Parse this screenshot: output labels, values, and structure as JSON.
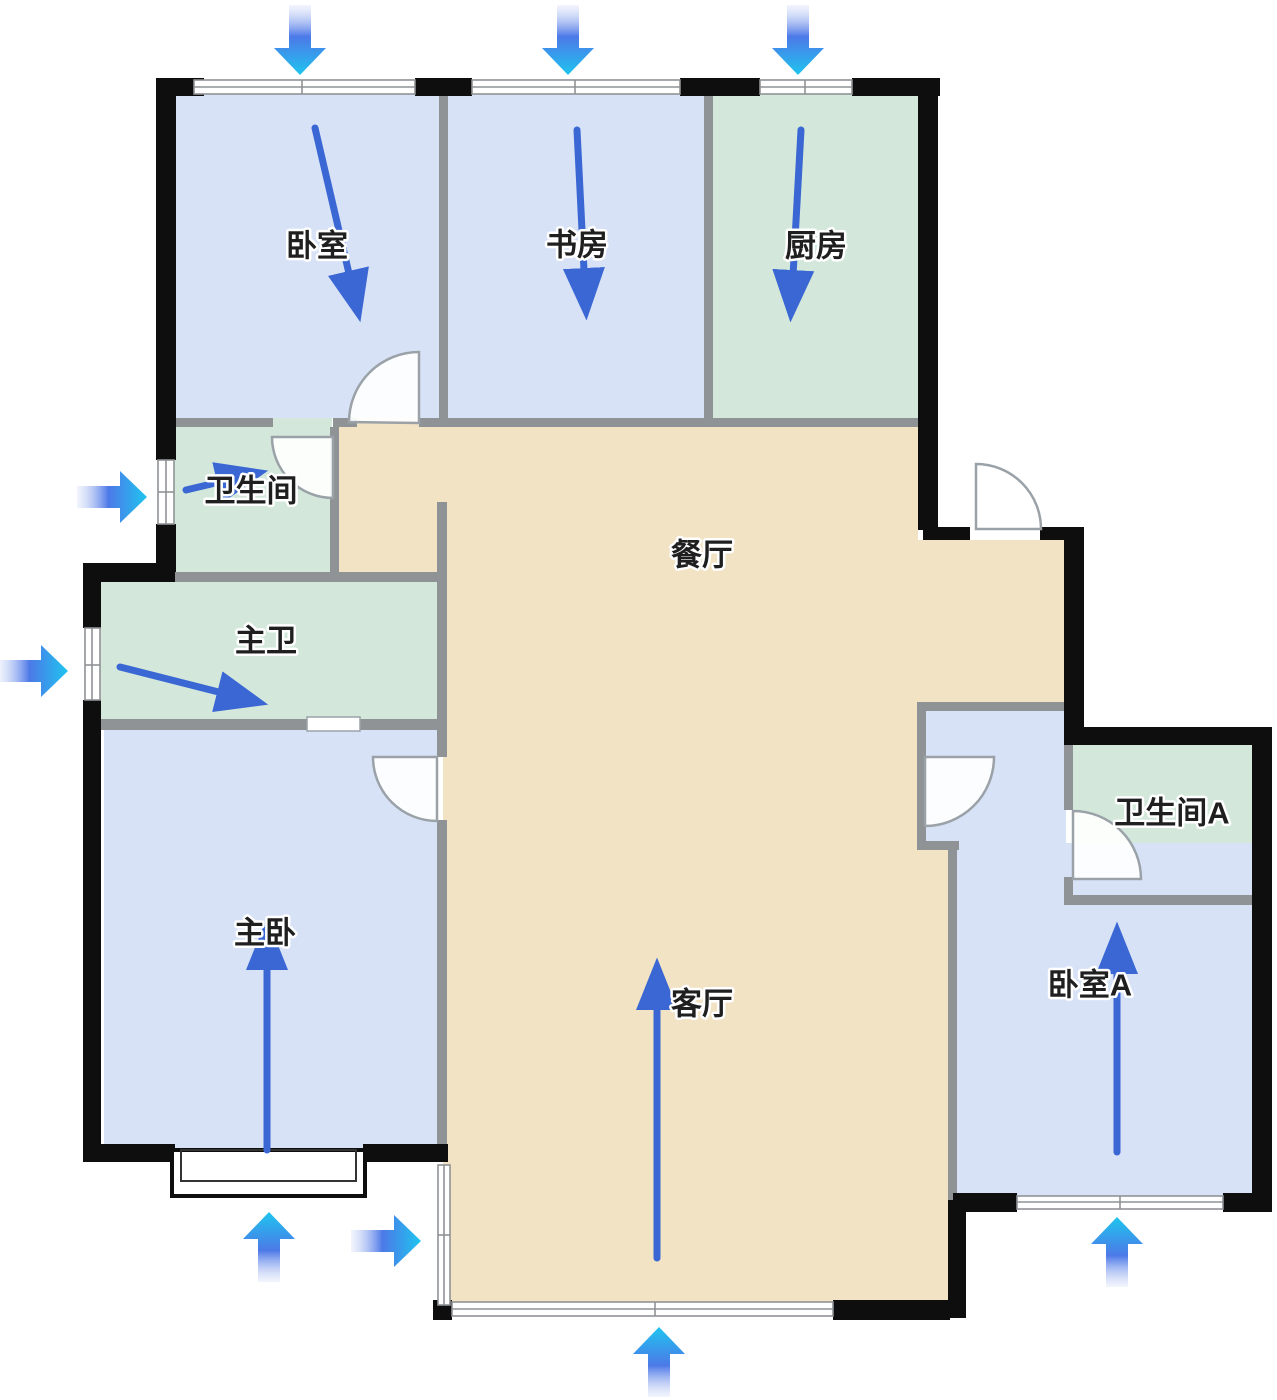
{
  "rooms": {
    "bedroom": {
      "label": "卧室"
    },
    "study": {
      "label": "书房"
    },
    "kitchen": {
      "label": "厨房"
    },
    "bathroom": {
      "label": "卫生间"
    },
    "master_bath": {
      "label": "主卫"
    },
    "dining": {
      "label": "餐厅"
    },
    "master_bedroom": {
      "label": "主卧"
    },
    "living": {
      "label": "客厅"
    },
    "bathroom_a": {
      "label": "卫生间A"
    },
    "bedroom_a": {
      "label": "卧室A"
    }
  },
  "colors": {
    "room_blue": "#d8e2f7",
    "room_green": "#d3e8db",
    "room_tan": "#f2e3c5",
    "wall_black": "#0e0e0e",
    "wall_gray": "#8f9396",
    "door_gray": "#9aa2a8",
    "flow_blue": "#3a67d4",
    "ext_tail": "#ccd5f7",
    "ext_mid": "#4c79e7",
    "ext_tip": "#1fc5ef",
    "label_black": "#1f1f1f",
    "background": "#ffffff"
  },
  "arrows": {
    "exterior": [
      {
        "id": "top-1",
        "direction": "down"
      },
      {
        "id": "top-2",
        "direction": "down"
      },
      {
        "id": "top-3",
        "direction": "down"
      },
      {
        "id": "left-1",
        "direction": "right"
      },
      {
        "id": "left-2",
        "direction": "right"
      },
      {
        "id": "bottom-1",
        "direction": "up"
      },
      {
        "id": "bottom-2",
        "direction": "right"
      },
      {
        "id": "bottom-3",
        "direction": "up"
      },
      {
        "id": "bottom-4",
        "direction": "up"
      }
    ],
    "interior": [
      {
        "room": "卧室",
        "direction": "down-right"
      },
      {
        "room": "书房",
        "direction": "down"
      },
      {
        "room": "厨房",
        "direction": "down"
      },
      {
        "room": "卫生间",
        "direction": "right"
      },
      {
        "room": "主卫",
        "direction": "down-right"
      },
      {
        "room": "主卧",
        "direction": "up"
      },
      {
        "room": "客厅",
        "direction": "up"
      },
      {
        "room": "卧室A",
        "direction": "up"
      }
    ]
  }
}
